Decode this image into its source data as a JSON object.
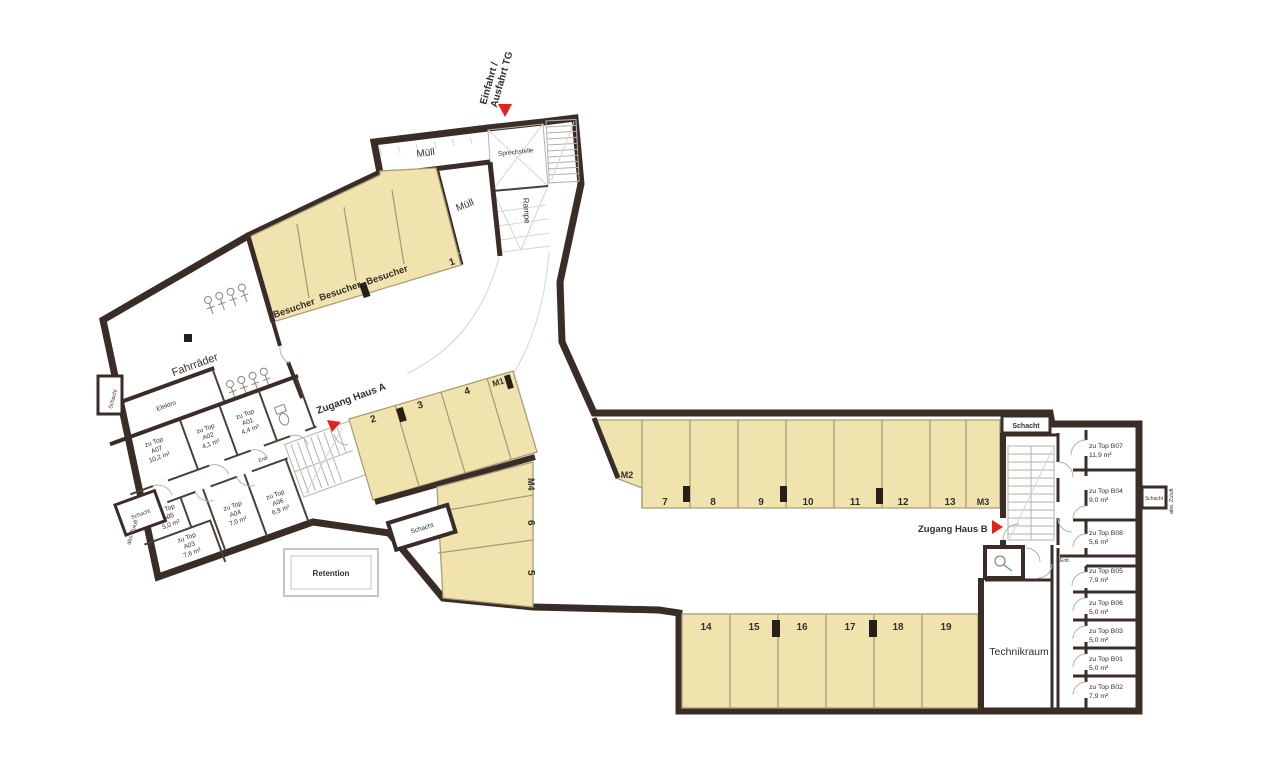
{
  "plan": {
    "colors": {
      "wall": "#3a2d28",
      "stall_fill": "#f1e3ad",
      "stall_line": "#a89d77",
      "accent_red": "#e2231a",
      "thin_line": "#b5b1aa",
      "text": "#33302c"
    },
    "entrance": {
      "line1": "Einfahrt /",
      "line2": "Ausfahrt TG"
    },
    "access": {
      "haus_a": "Zugang Haus A",
      "haus_b": "Zugang Haus B"
    },
    "areas": {
      "muell_top": "Müll",
      "muell_side": "Müll",
      "sprechstelle": "Sprechstelle",
      "rampe": "Rampe",
      "besucher": "Besucher",
      "fahrraeder": "Fahrräder",
      "elektro": "Elektro",
      "retention": "Retention",
      "technikraum": "Technikraum",
      "schacht": "Schacht",
      "abs_zuluft": "abs. Zuluft",
      "entl": "Entl."
    },
    "stalls": {
      "numbers": [
        "1",
        "2",
        "3",
        "4",
        "5",
        "6",
        "7",
        "8",
        "9",
        "10",
        "11",
        "12",
        "13",
        "14",
        "15",
        "16",
        "17",
        "18",
        "19"
      ],
      "moto": [
        "M1",
        "M2",
        "M3",
        "M4"
      ]
    },
    "rooms_a": [
      {
        "prefix": "zu Top",
        "name": "A07",
        "area": "10,2 m²"
      },
      {
        "prefix": "zu Top",
        "name": "A02",
        "area": "4,1 m²"
      },
      {
        "prefix": "zu Top",
        "name": "A01",
        "area": "4,4 m²"
      },
      {
        "prefix": "zu Top",
        "name": "A05",
        "area": "5,0 m²"
      },
      {
        "prefix": "zu Top",
        "name": "A04",
        "area": "7,0 m²"
      },
      {
        "prefix": "zu Top",
        "name": "A06",
        "area": "6,9 m²"
      },
      {
        "prefix": "zu Top",
        "name": "A03",
        "area": "7,6 m²"
      }
    ],
    "rooms_b": [
      {
        "name": "zu Top B07",
        "area": "11,9 m²"
      },
      {
        "name": "zu Top B04",
        "area": "9,0 m²"
      },
      {
        "name": "zu Top B08",
        "area": "5,6 m²"
      },
      {
        "name": "zu Top B05",
        "area": "7,9 m²"
      },
      {
        "name": "zu Top B06",
        "area": "5,0 m²"
      },
      {
        "name": "zu Top B03",
        "area": "5,0 m²"
      },
      {
        "name": "zu Top B01",
        "area": "5,0 m²"
      },
      {
        "name": "zu Top B02",
        "area": "7,9 m²"
      }
    ]
  }
}
